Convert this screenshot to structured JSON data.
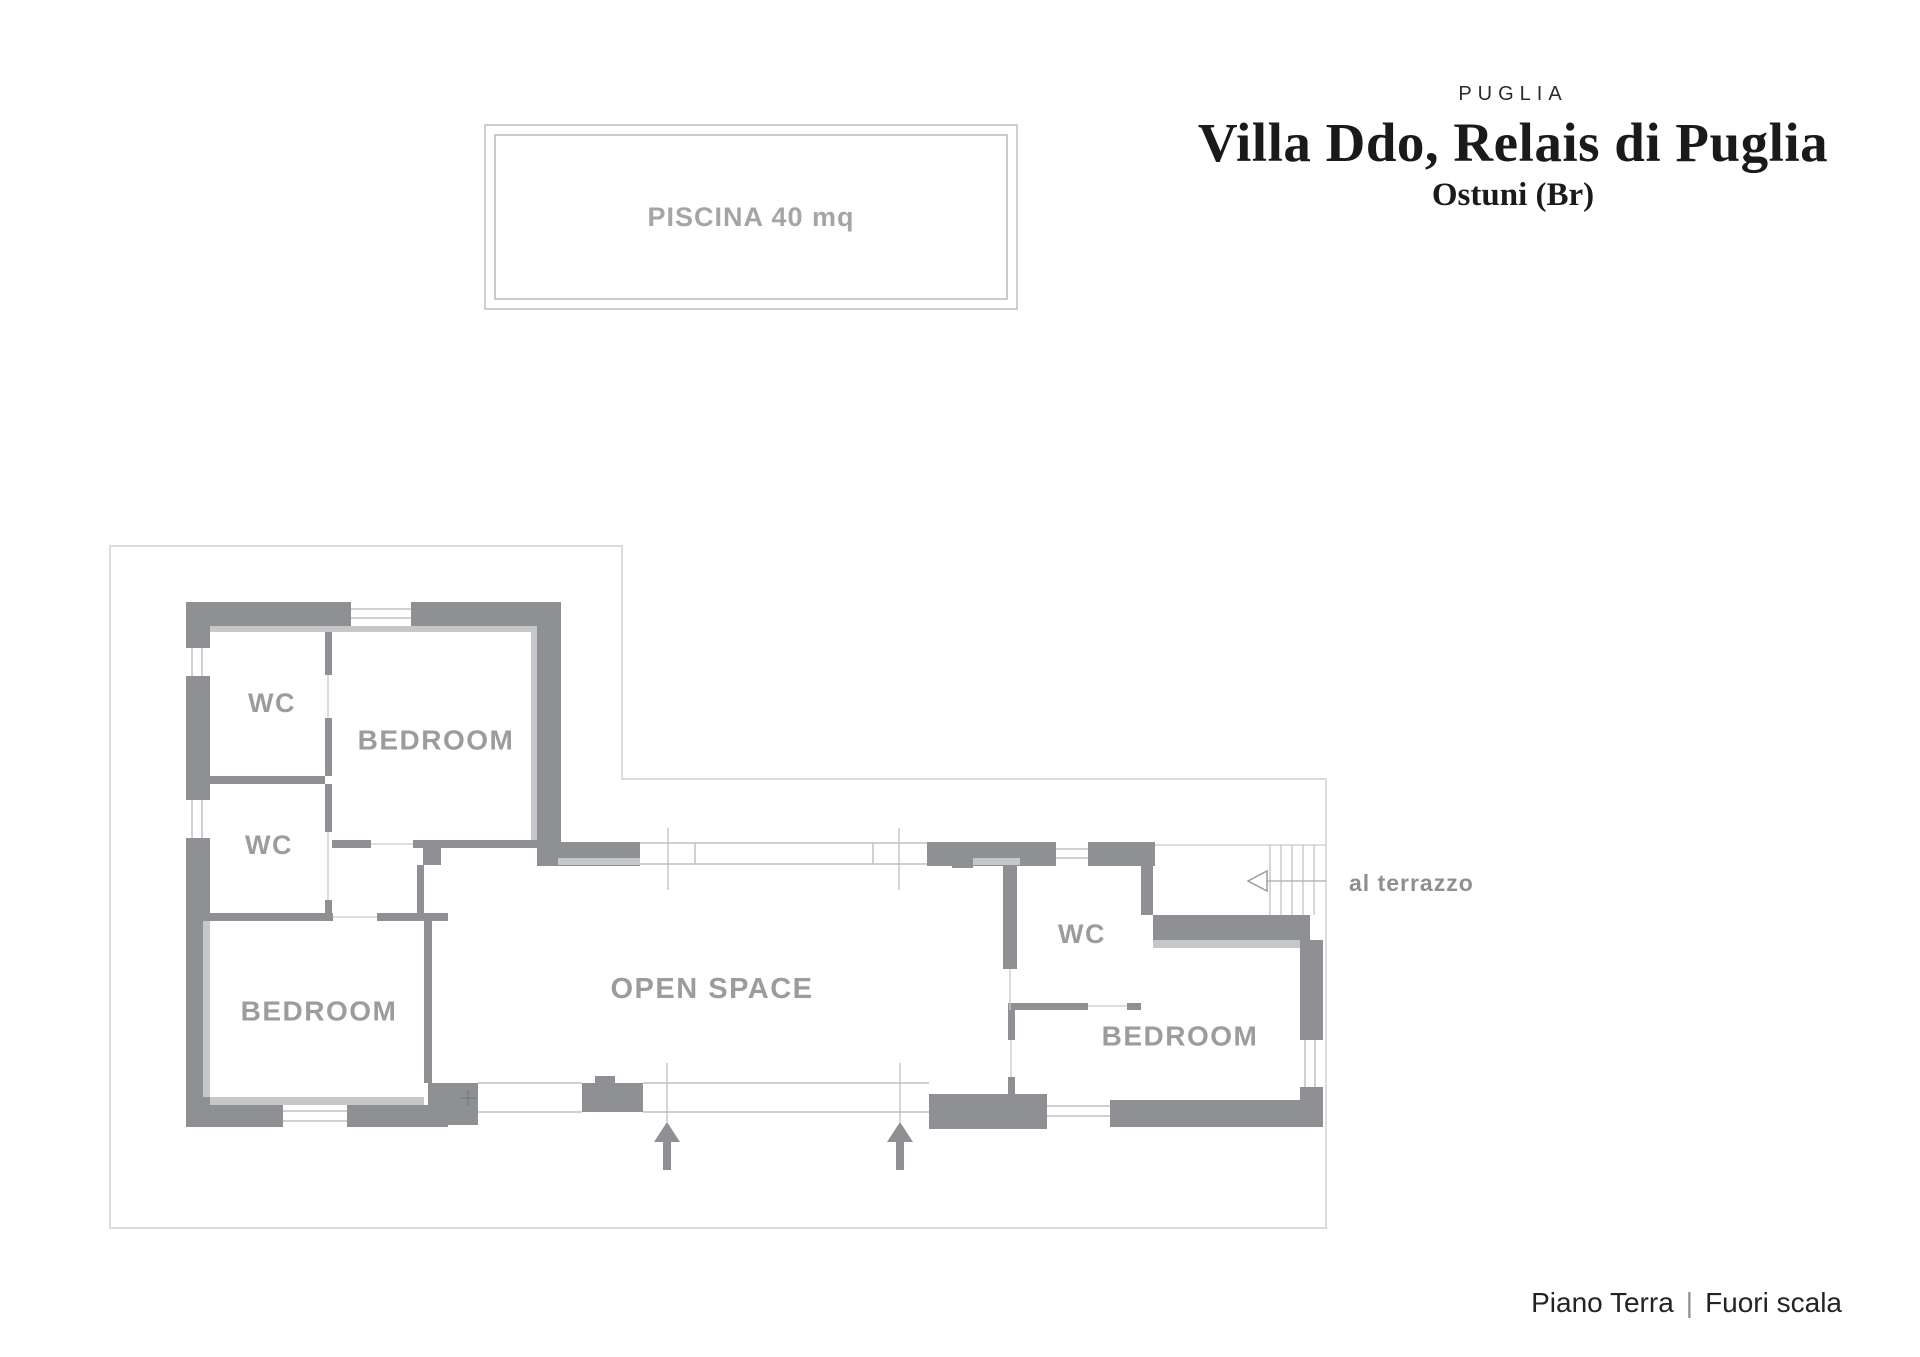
{
  "header": {
    "region": "PUGLIA",
    "title": "Villa Ddo, Relais di Puglia",
    "location": "Ostuni (Br)"
  },
  "pool": {
    "label": "PISCINA 40 mq"
  },
  "plan": {
    "rooms": [
      {
        "id": "wc-top-left",
        "label": "WC"
      },
      {
        "id": "bedroom-top",
        "label": "BEDROOM"
      },
      {
        "id": "wc-mid-left",
        "label": "WC"
      },
      {
        "id": "bedroom-left",
        "label": "BEDROOM"
      },
      {
        "id": "open-space",
        "label": "OPEN SPACE"
      },
      {
        "id": "wc-right",
        "label": "WC"
      },
      {
        "id": "bedroom-right",
        "label": "BEDROOM"
      }
    ],
    "terrace_note": "al terrazzo"
  },
  "footer": {
    "floor_label": "Piano Terra",
    "separator": "|",
    "scale_label": "Fuori scala"
  },
  "colors": {
    "wall": "#8e9093",
    "wall_inset": "#c5c7c8",
    "site_boundary": "#dbdcdd",
    "glass_line": "#bfc1c2",
    "room_text": "#9a9c9e",
    "terrace_text": "#8d9093",
    "pool_border": "#cdced0",
    "pool_text": "#a3a5a7",
    "title_text": "#1a1a1c",
    "footer_text": "#232326"
  }
}
